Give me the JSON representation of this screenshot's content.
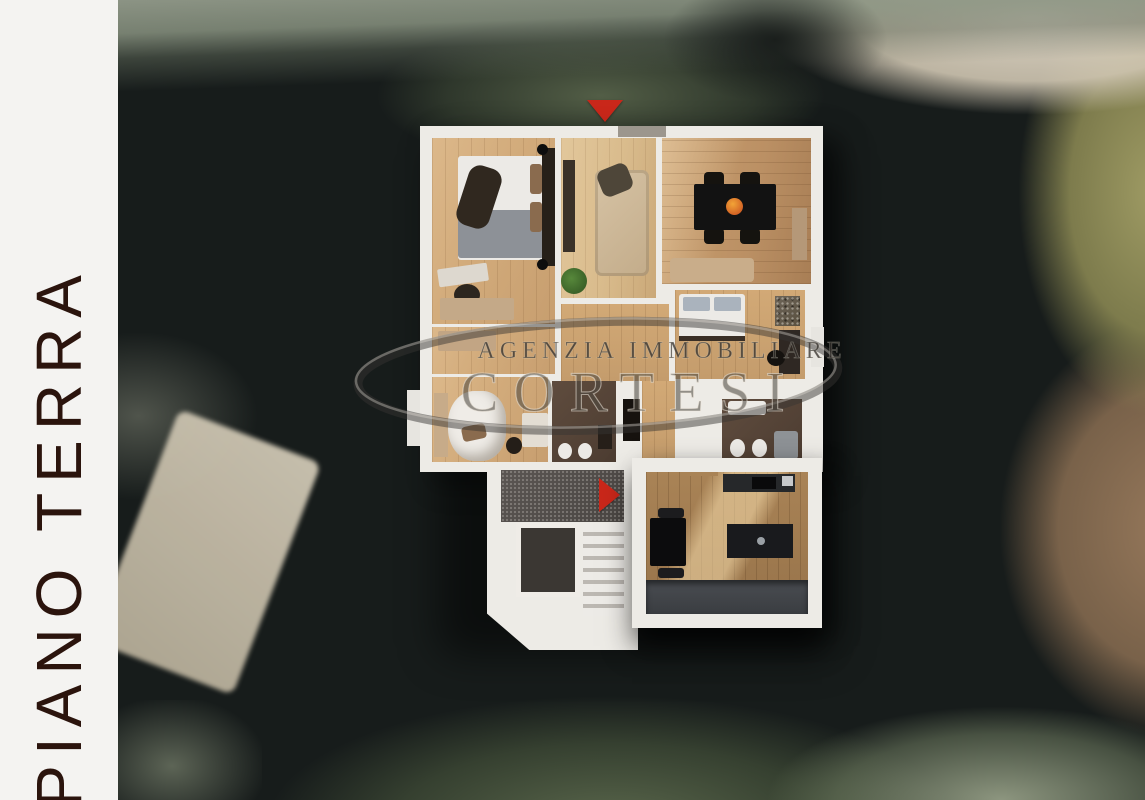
{
  "floor_panel": {
    "label": "PIANO TERRA"
  },
  "watermark": {
    "agency_line": "AGENZIA IMMOBILIARE",
    "brand": "CORTESI"
  },
  "markers": {
    "top_entrance_icon": "red-triangle-down",
    "stair_entrance_icon": "red-triangle-right",
    "accent_color": "#c9271a"
  },
  "plan": {
    "type": "floorplan-3d-top-view",
    "rooms": [
      "bedroom-1",
      "living-room",
      "dining-room",
      "bedroom-2",
      "bedroom-3-canopy",
      "hallway",
      "bathroom-center",
      "bathroom-right",
      "stairwell",
      "kitchen-dining",
      "terrace"
    ],
    "wall_color": "#edebe6",
    "wood_light": "#d2ab7b",
    "wood_medium": "#bb9064",
    "wood_kitchen": "#a98356",
    "bath_floor": "#4c3c31"
  },
  "background": {
    "scene": "aerial-satellite-photo",
    "features": [
      "trees-dark",
      "grass-band-top",
      "tan-road-top-right",
      "olive-trees-right",
      "brown-field-bottom-right",
      "beige-roof-bottom-left"
    ]
  }
}
